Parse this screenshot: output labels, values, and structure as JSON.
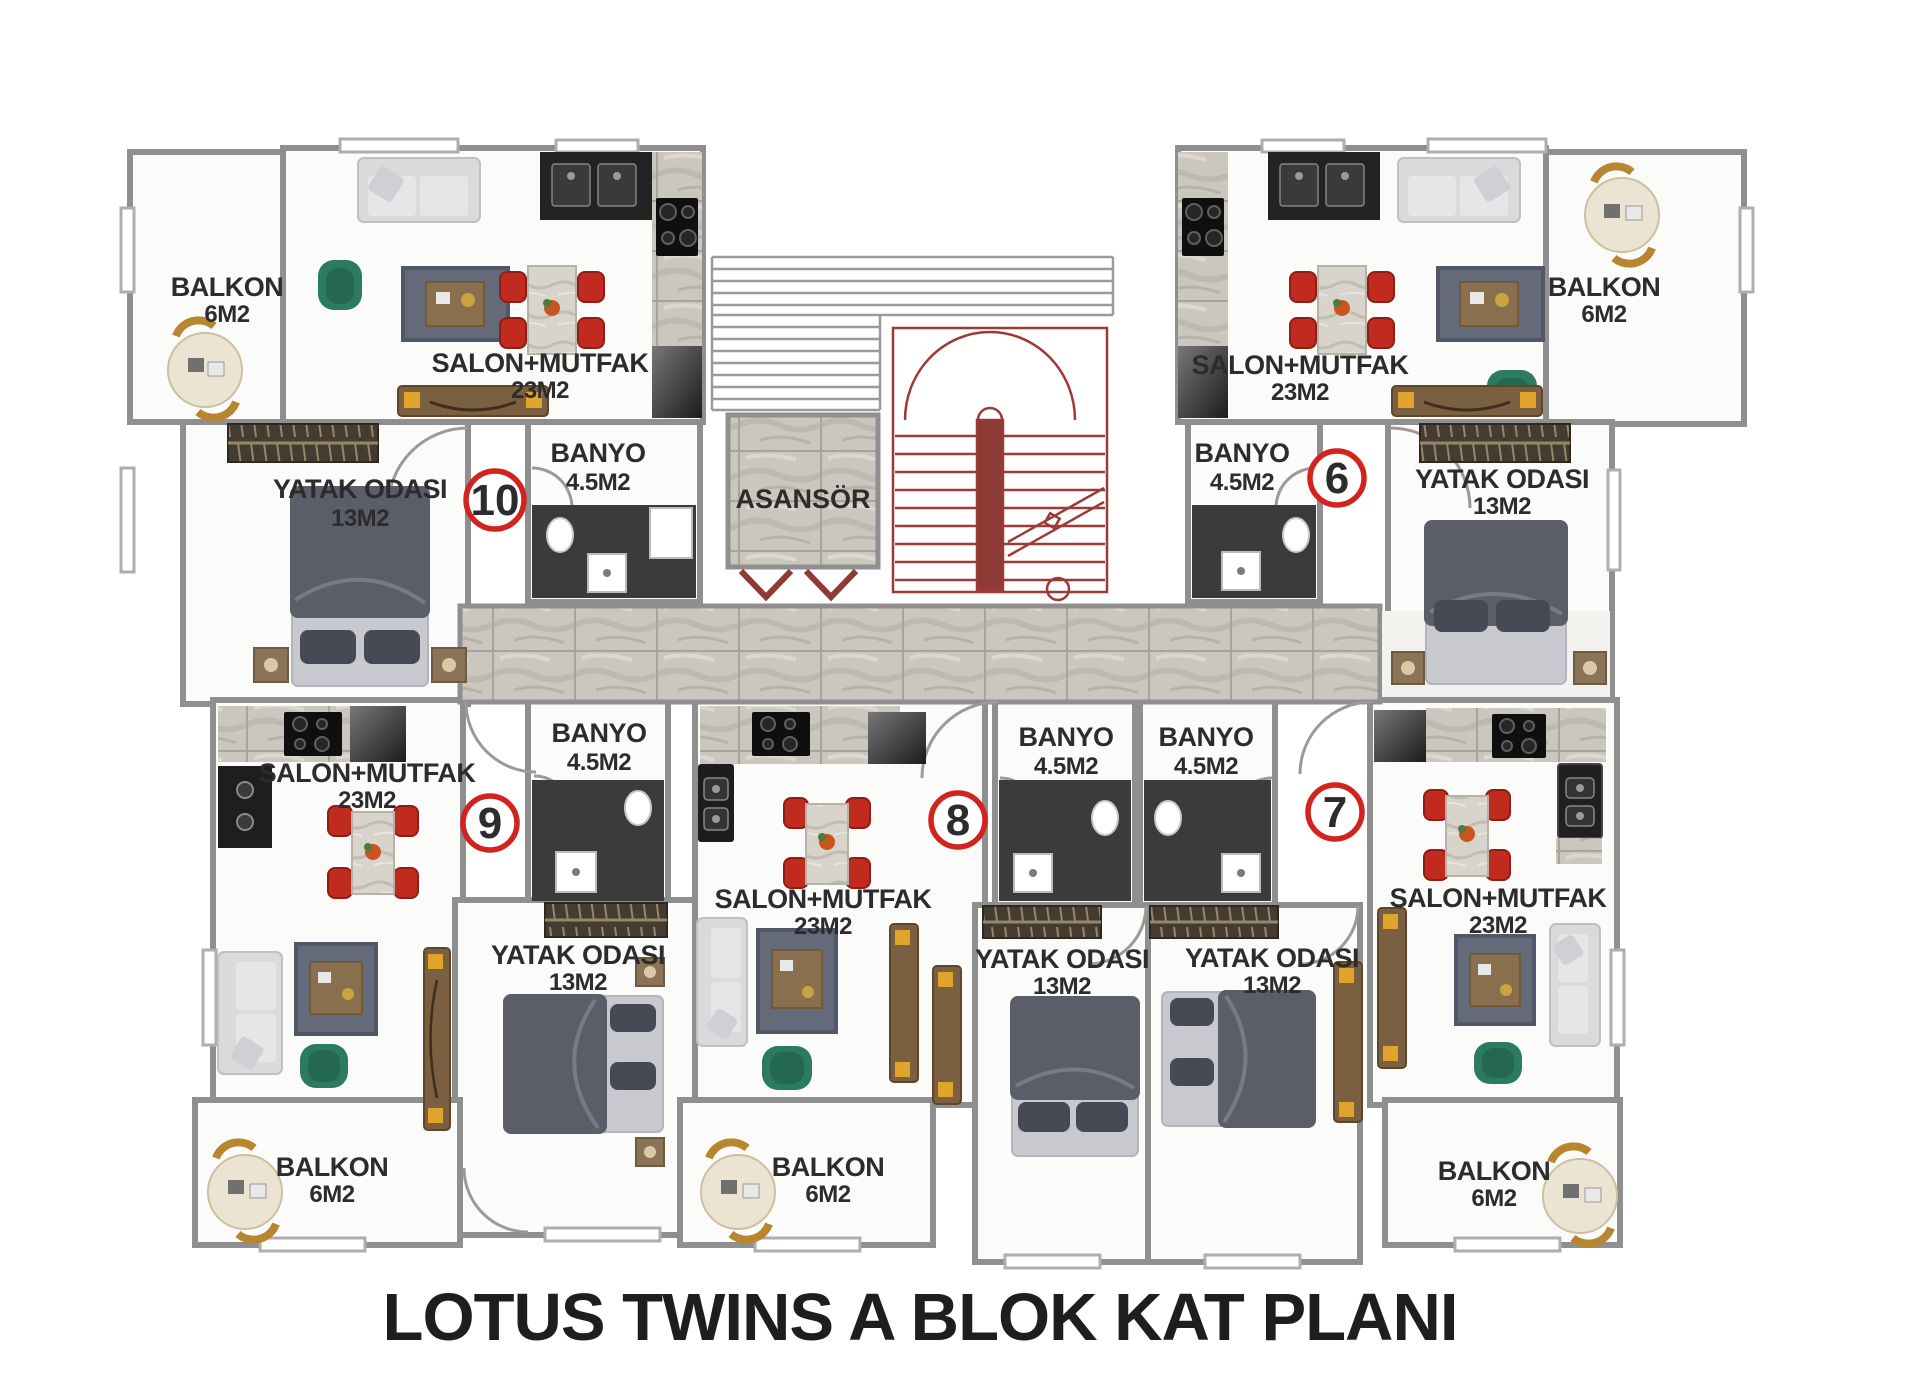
{
  "title": "LOTUS TWINS A BLOK KAT PLANI",
  "elevator_label": "ASANSÖR",
  "colors": {
    "wall": "#8f8f8f",
    "stair_red": "#9e3a35",
    "unit_circle": "#d2231f",
    "dining_chair": "#c02a1f",
    "armchair_green": "#2d7b5e",
    "marble": "#cbc7bf",
    "balcony_gold": "#b8862f",
    "text": "#2c2c2c"
  },
  "apartments": [
    {
      "number": "10",
      "position": "top-left",
      "salon": {
        "label": "SALON+MUTFAK",
        "area": "23M2"
      },
      "bedroom": {
        "label": "YATAK ODASI",
        "area": "13M2"
      },
      "bathroom": {
        "label": "BANYO",
        "area": "4.5M2"
      },
      "balcony": {
        "label": "BALKON",
        "area": "6M2"
      }
    },
    {
      "number": "6",
      "position": "top-right",
      "salon": {
        "label": "SALON+MUTFAK",
        "area": "23M2"
      },
      "bedroom": {
        "label": "YATAK ODASI",
        "area": "13M2"
      },
      "bathroom": {
        "label": "BANYO",
        "area": "4.5M2"
      },
      "balcony": {
        "label": "BALKON",
        "area": "6M2"
      }
    },
    {
      "number": "9",
      "position": "bottom-left",
      "salon": {
        "label": "SALON+MUTFAK",
        "area": "23M2"
      },
      "bedroom": {
        "label": "YATAK ODASI",
        "area": "13M2"
      },
      "bathroom": {
        "label": "BANYO",
        "area": "4.5M2"
      },
      "balcony": {
        "label": "BALKON",
        "area": "6M2"
      }
    },
    {
      "number": "8",
      "position": "bottom-middle",
      "salon": {
        "label": "SALON+MUTFAK",
        "area": "23M2"
      },
      "bedroom": {
        "label": "YATAK ODASI",
        "area": "13M2"
      },
      "bathroom": {
        "label": "BANYO",
        "area": "4.5M2"
      },
      "balcony": {
        "label": "BALKON",
        "area": "6M2"
      }
    },
    {
      "number": "7",
      "position": "bottom-right",
      "salon": {
        "label": "SALON+MUTFAK",
        "area": "23M2"
      },
      "bedroom": {
        "label": "YATAK ODASI",
        "area": "13M2"
      },
      "bathroom": {
        "label": "BANYO",
        "area": "4.5M2"
      },
      "balcony": {
        "label": "BALKON",
        "area": "6M2"
      }
    }
  ]
}
